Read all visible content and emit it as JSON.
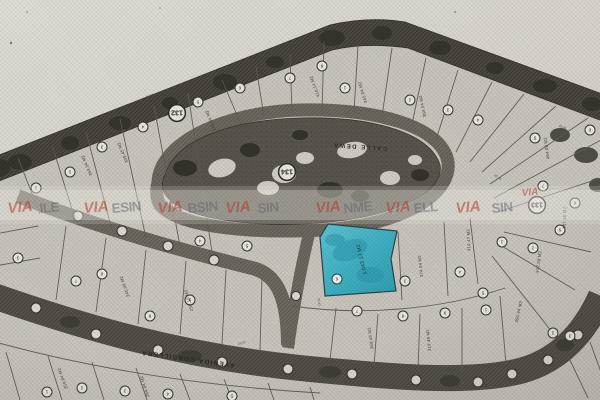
{
  "map": {
    "streets": [
      {
        "name": "AVENIDA CORDILLERA"
      },
      {
        "name": "CALLE DEWA"
      }
    ],
    "blocks": [
      {
        "number": "132",
        "x": 177,
        "y": 113
      },
      {
        "number": "134",
        "x": 287,
        "y": 172
      },
      {
        "number": "133",
        "x": 537,
        "y": 205
      }
    ],
    "highlight_lot": {
      "number": "6",
      "area_text": "1,043.17 M2",
      "fill": "#3fb0c2"
    },
    "lot_markers": [
      {
        "x": 36,
        "y": 188,
        "n": "1"
      },
      {
        "x": 70,
        "y": 172,
        "n": "2"
      },
      {
        "x": 102,
        "y": 147,
        "n": "3"
      },
      {
        "x": 143,
        "y": 127,
        "n": "4"
      },
      {
        "x": 198,
        "y": 102,
        "n": "5"
      },
      {
        "x": 240,
        "y": 88,
        "n": "6"
      },
      {
        "x": 290,
        "y": 78,
        "n": "7"
      },
      {
        "x": 322,
        "y": 66,
        "n": "8"
      },
      {
        "x": 345,
        "y": 88,
        "n": "1"
      },
      {
        "x": 410,
        "y": 100,
        "n": "2"
      },
      {
        "x": 448,
        "y": 110,
        "n": "3"
      },
      {
        "x": 478,
        "y": 120,
        "n": "4"
      },
      {
        "x": 535,
        "y": 138,
        "n": "5"
      },
      {
        "x": 590,
        "y": 130,
        "n": "6"
      },
      {
        "x": 543,
        "y": 186,
        "n": "7"
      },
      {
        "x": 575,
        "y": 203,
        "n": "8"
      },
      {
        "x": 560,
        "y": 230,
        "n": "9"
      },
      {
        "x": 502,
        "y": 242,
        "n": "1"
      },
      {
        "x": 533,
        "y": 248,
        "n": "2"
      },
      {
        "x": 405,
        "y": 281,
        "n": "3"
      },
      {
        "x": 460,
        "y": 272,
        "n": "4"
      },
      {
        "x": 483,
        "y": 293,
        "n": "5"
      },
      {
        "x": 357,
        "y": 311,
        "n": "7"
      },
      {
        "x": 403,
        "y": 316,
        "n": "8"
      },
      {
        "x": 445,
        "y": 313,
        "n": "9"
      },
      {
        "x": 486,
        "y": 310,
        "n": "1"
      },
      {
        "x": 553,
        "y": 333,
        "n": "2"
      },
      {
        "x": 570,
        "y": 336,
        "n": "3"
      },
      {
        "x": 200,
        "y": 241,
        "n": "4"
      },
      {
        "x": 247,
        "y": 246,
        "n": "5"
      },
      {
        "x": 102,
        "y": 274,
        "n": "6"
      },
      {
        "x": 76,
        "y": 281,
        "n": "7"
      },
      {
        "x": 150,
        "y": 316,
        "n": "8"
      },
      {
        "x": 190,
        "y": 300,
        "n": "9"
      },
      {
        "x": 18,
        "y": 258,
        "n": "3"
      },
      {
        "x": 47,
        "y": 392,
        "n": "1"
      },
      {
        "x": 82,
        "y": 388,
        "n": "2"
      },
      {
        "x": 125,
        "y": 391,
        "n": "3"
      },
      {
        "x": 168,
        "y": 394,
        "n": "4"
      },
      {
        "x": 232,
        "y": 396,
        "n": "5"
      }
    ],
    "area_labels": [
      {
        "t": "364.94 M2",
        "x": 88,
        "y": 165,
        "r": 247
      },
      {
        "t": "339.45 M2",
        "x": 124,
        "y": 152,
        "r": 247
      },
      {
        "t": "344.04 M2",
        "x": 212,
        "y": 120,
        "r": 247
      },
      {
        "t": "410.14 M2",
        "x": 316,
        "y": 86,
        "r": 250
      },
      {
        "t": "345.04 M2",
        "x": 364,
        "y": 92,
        "r": 253
      },
      {
        "t": "364.04 M2",
        "x": 424,
        "y": 106,
        "r": 258
      },
      {
        "t": "464.08 M2",
        "x": 548,
        "y": 148,
        "r": 262
      },
      {
        "t": "447.35 M2",
        "x": 566,
        "y": 218,
        "r": 272
      },
      {
        "t": "412.59 M2",
        "x": 540,
        "y": 262,
        "r": 278
      },
      {
        "t": "410.47 M2",
        "x": 470,
        "y": 240,
        "r": 268
      },
      {
        "t": "374.04 M2",
        "x": 422,
        "y": 266,
        "r": 264
      },
      {
        "t": "319.48 M2",
        "x": 430,
        "y": 340,
        "r": 265
      },
      {
        "t": "369.46 M2",
        "x": 372,
        "y": 338,
        "r": 262
      },
      {
        "t": "245.99 M2",
        "x": 126,
        "y": 286,
        "r": 250
      },
      {
        "t": "258.19 M2",
        "x": 190,
        "y": 300,
        "r": 253
      },
      {
        "t": "259.04 M2",
        "x": 64,
        "y": 378,
        "r": 250
      },
      {
        "t": "264.04 M2",
        "x": 146,
        "y": 386,
        "r": 252
      },
      {
        "t": "350.44 M2",
        "x": 520,
        "y": 312,
        "r": 282
      }
    ],
    "dim_labels": [
      {
        "t": "16.00",
        "x": 52,
        "y": 206,
        "r": -21
      },
      {
        "t": "35.00",
        "x": 150,
        "y": 97,
        "r": -21
      },
      {
        "t": "14.22",
        "x": 302,
        "y": 127,
        "r": -6
      },
      {
        "t": "40.28",
        "x": 497,
        "y": 178,
        "r": 35
      },
      {
        "t": "35.43",
        "x": 318,
        "y": 302,
        "r": 84
      },
      {
        "t": "16.00",
        "x": 242,
        "y": 344,
        "r": -14
      },
      {
        "t": "38.00",
        "x": 562,
        "y": 128,
        "r": 22
      },
      {
        "t": "35.00",
        "x": 420,
        "y": 196,
        "r": -80
      }
    ],
    "watermark": {
      "items": [
        {
          "t": "VIA",
          "c": "red",
          "x": 8
        },
        {
          "t": "ILE",
          "c": "gray",
          "x": 40
        },
        {
          "t": "VIA",
          "c": "red",
          "x": 84
        },
        {
          "t": "ESIN",
          "c": "gray",
          "x": 112
        },
        {
          "t": "VIA",
          "c": "red",
          "x": 158
        },
        {
          "t": "BSIN",
          "c": "gray",
          "x": 188
        },
        {
          "t": "VIA",
          "c": "red",
          "x": 226
        },
        {
          "t": "SIN",
          "c": "gray",
          "x": 258
        },
        {
          "t": "VIA",
          "c": "red",
          "x": 316
        },
        {
          "t": "NME",
          "c": "gray",
          "x": 344
        },
        {
          "t": "VIA",
          "c": "red",
          "x": 386
        },
        {
          "t": "ELL",
          "c": "gray",
          "x": 414
        },
        {
          "t": "VIA",
          "c": "red",
          "x": 456
        },
        {
          "t": "SIN",
          "c": "gray",
          "x": 492
        },
        {
          "t": "VIA",
          "c": "red",
          "x": 522,
          "y": 196,
          "s": 10
        }
      ]
    },
    "colors": {
      "paper": "#d9d6cf",
      "plat": "#cac6be",
      "greenbelt": "#4d4941",
      "road": "#6e6a61",
      "park": "#59554c",
      "highlight": "#3fb0c2",
      "watermark_red": "#b23c30",
      "ink": "#2f2c27"
    }
  }
}
